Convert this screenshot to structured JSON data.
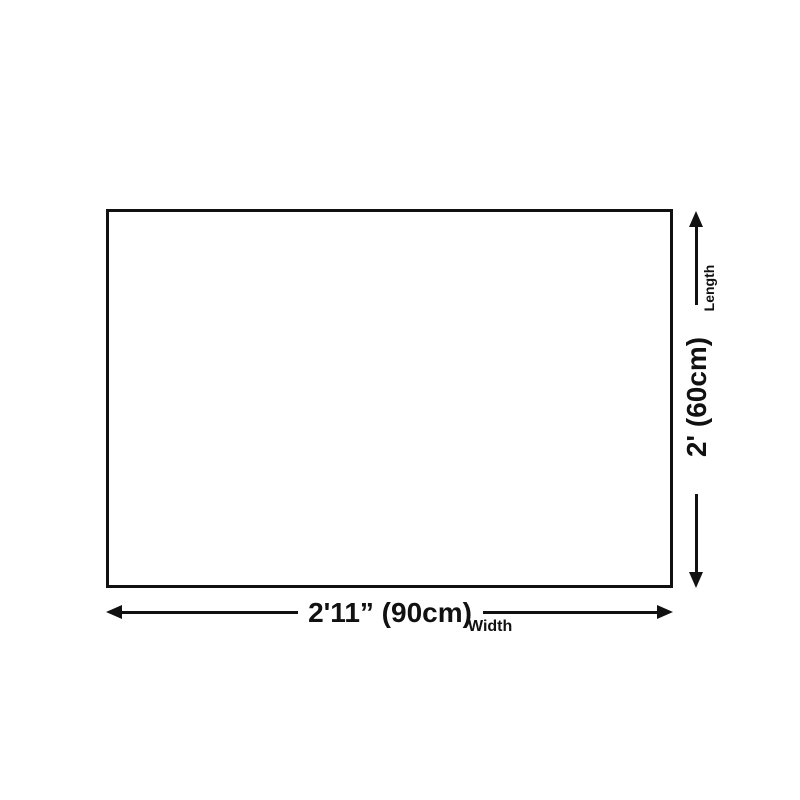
{
  "diagram": {
    "type": "product-dimension-diagram",
    "background_color": "#ffffff",
    "line_color": "#111111",
    "length_dimension": {
      "name": "Length",
      "value": "2' (60cm)"
    },
    "width_dimension": {
      "name": "Width",
      "value": "2'11” (90cm)"
    },
    "icons": {
      "up": "arrow-up-icon",
      "down": "arrow-down-icon",
      "left": "arrow-left-icon",
      "right": "arrow-right-icon"
    }
  }
}
